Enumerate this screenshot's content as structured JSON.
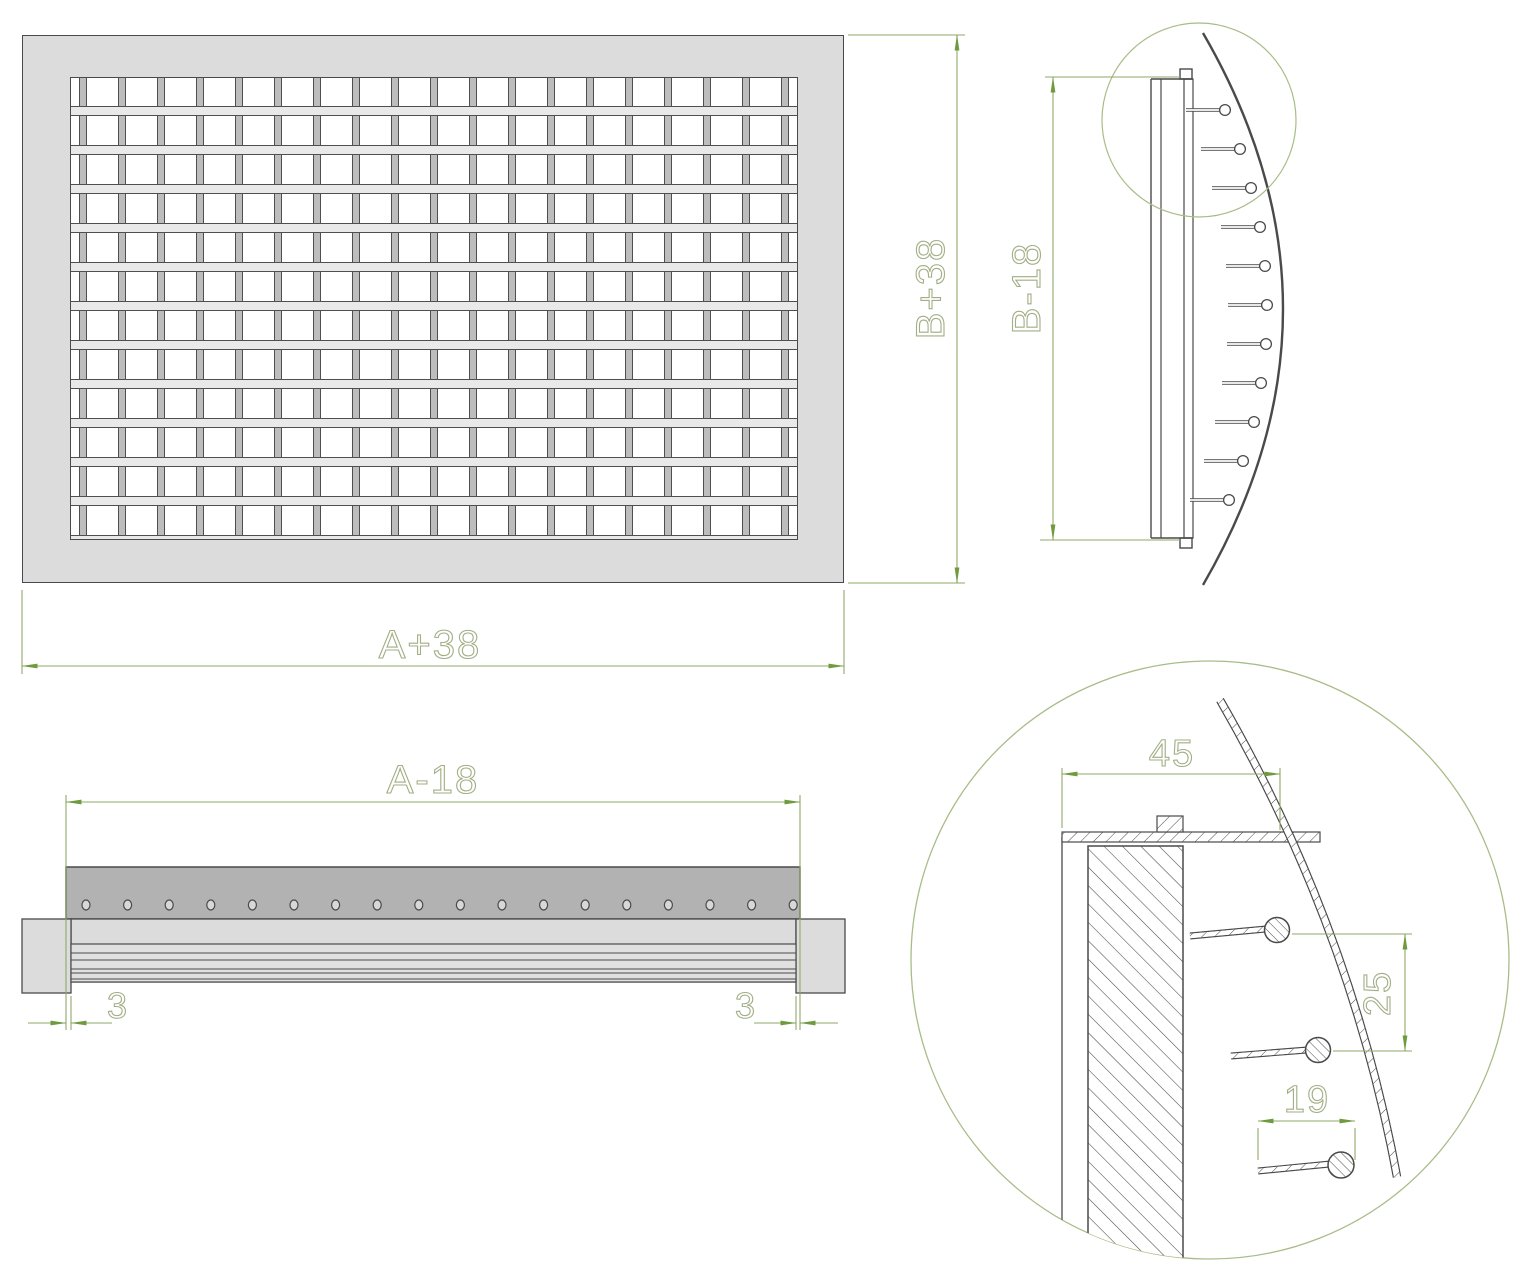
{
  "drawing": {
    "title": "egg-crate grille technical drawing",
    "front_view": {
      "width_dim": "A+38",
      "height_dim": "B+38"
    },
    "side_view": {
      "height_dim": "B-18"
    },
    "section_view": {
      "width_dim": "A-18",
      "edge_offset_left": "3",
      "edge_offset_right": "3"
    },
    "detail_view": {
      "frame_depth": "45",
      "pin_spacing": "25",
      "pin_length": "19"
    },
    "colors": {
      "dimension_line": "#8fa86a",
      "dimension_arrow": "#6f9a3f",
      "dimension_text": "#a2ae85",
      "detail_circle": "#a9bc88",
      "drawing_line": "#4a4a4a",
      "frame_fill": "#dcdcdc",
      "back_panel_fill": "#b2b2b2",
      "rail_fill": "#e9e9e9",
      "bar_fill": "#bdbdbd"
    }
  }
}
